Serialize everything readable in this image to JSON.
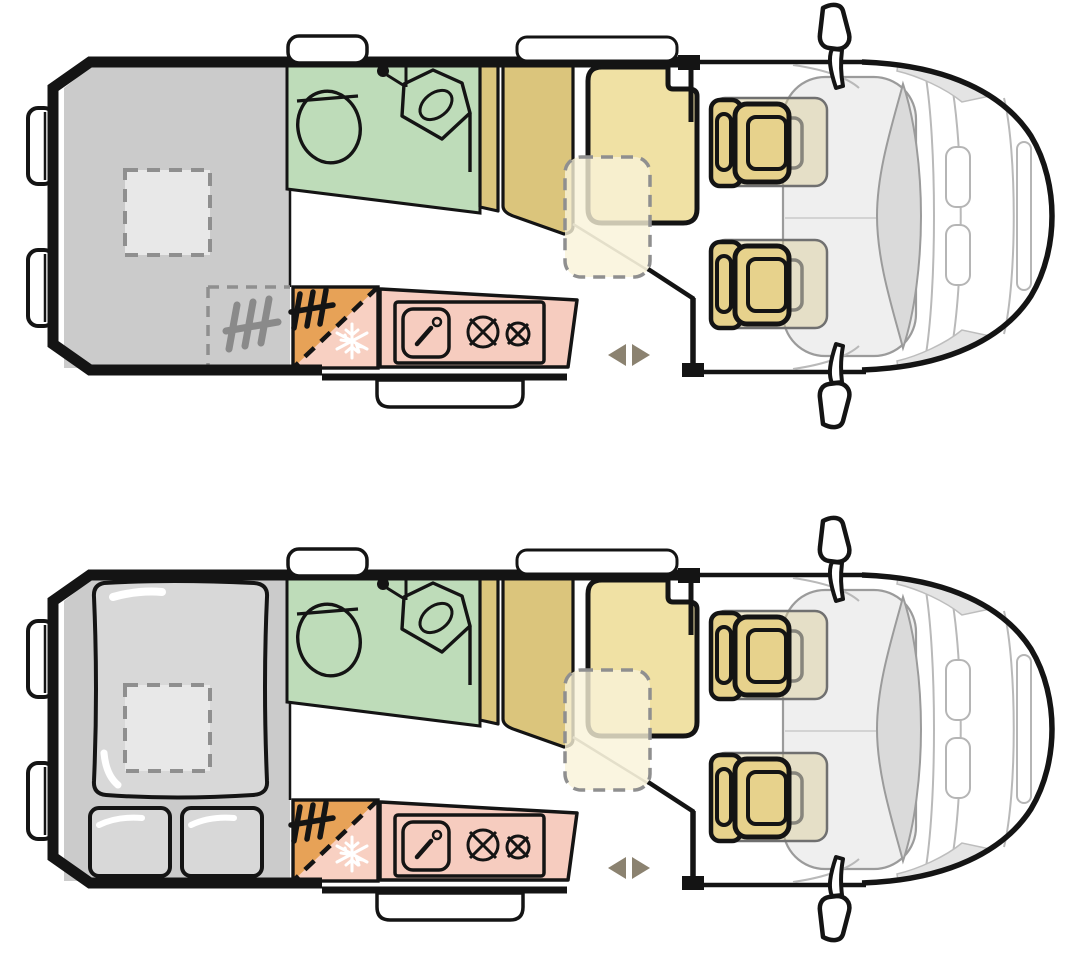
{
  "page": {
    "background": "#ffffff"
  },
  "colors": {
    "background": "#ffffff",
    "outline": "#141414",
    "bed_gray": "#cbcbcb",
    "hatch_gray": "#e8e8e8",
    "duvet_gray": "#d8d8d8",
    "bathroom_green": "#bedcb9",
    "wardrobe_tan": "#dbc57c",
    "bench_tan": "#f0e1a4",
    "table_cream": "#f9f2d8",
    "seat_tan": "#e7d28c",
    "seat_ghost": "#d9cb97",
    "heater_orange": "#e7a257",
    "fridge_pink": "#f8d0c2",
    "kitchen_pink": "#f6ccbf",
    "arrow_khaki": "#8b8270",
    "glass_gray": "#dadada",
    "cab_gray": "#efefef",
    "hood_patch_gray": "#e4e4e4",
    "body_line_gray": "#b9b9b9",
    "dash_gray": "#8f8f8f",
    "heater_icon_gray": "#8a8a8a",
    "snowflake_white": "#ffffff",
    "highlight_white": "#ffffff",
    "step_white": "#ffffff"
  },
  "diagram": {
    "type": "campervan-floorplan",
    "views": [
      {
        "id": "day-layout",
        "rear_state": "bed-platform-empty",
        "extras": [
          "underbed-heater-zone-dashed",
          "underbed-heater-icon"
        ]
      },
      {
        "id": "night-layout",
        "rear_state": "bed-made-up",
        "extras": [
          "duvet",
          "pillow-left",
          "pillow-right"
        ]
      }
    ],
    "features": [
      "rear-bed-area",
      "roof-hatch-dashed",
      "rear-door-hinges",
      "bathroom",
      "toilet",
      "corner-washbasin",
      "tap-dot",
      "wardrobe",
      "dinette-bench",
      "seatbelt-notch",
      "folding-table-dashed",
      "heater-compartment",
      "fridge-compartment",
      "snowflake-icon",
      "heater-icon",
      "kitchen-counter",
      "sink",
      "faucet",
      "hob-burner-large",
      "hob-burner-small",
      "sliding-door-sill",
      "entry-step",
      "door-direction-arrows",
      "cab-seat-driver",
      "cab-seat-passenger",
      "seat-swivel-ghost",
      "dashboard",
      "windshield",
      "hood-crease-lines",
      "grille-slots",
      "front-bumper-slot",
      "side-mirror-top",
      "side-mirror-bottom",
      "window-bathroom",
      "window-dinette",
      "van-front-outline"
    ]
  }
}
